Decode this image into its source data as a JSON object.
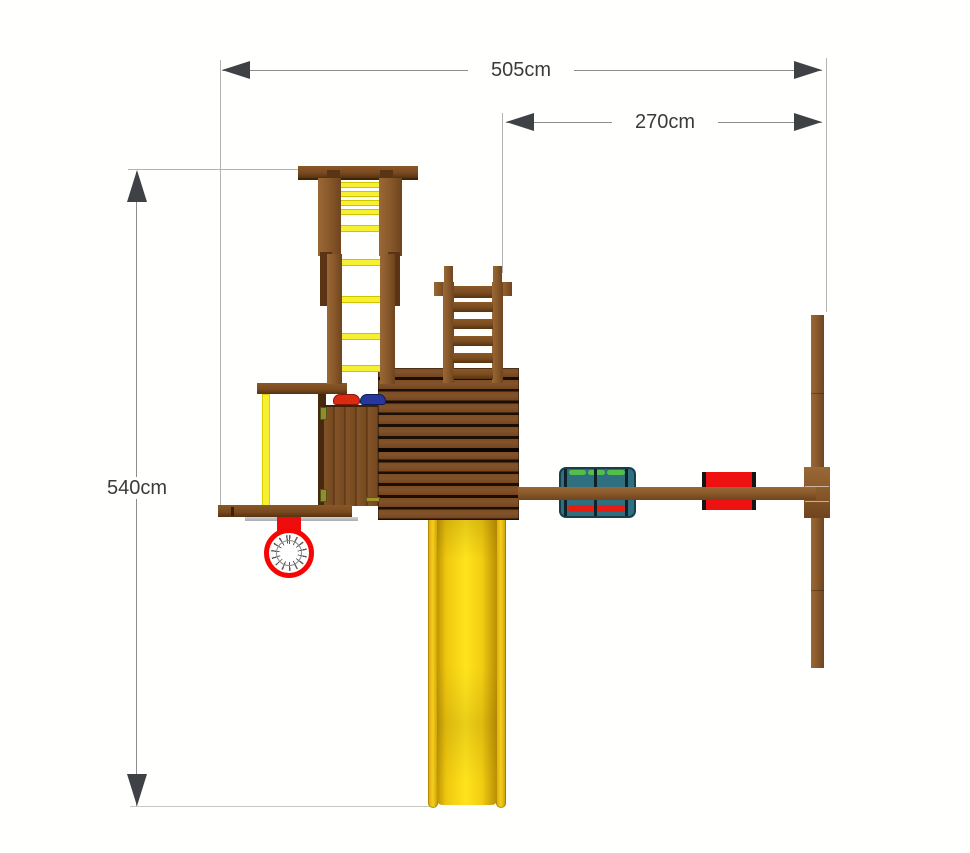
{
  "diagram": {
    "type": "playground-plan-view",
    "dimensions": {
      "total_width": "505cm",
      "swing_width": "270cm",
      "total_depth": "540cm"
    },
    "colors": {
      "wood": "#8a5a2b",
      "wood_hi": "#9a6836",
      "wood_lo": "#6f441e",
      "wood_dark": "#7a4b21",
      "yellow": "#f7f032",
      "red": "#ee1111",
      "hoop_red": "#f70505",
      "teal": "#2f6f7f",
      "green": "#55bd4a",
      "blue_hold": "#27379b",
      "dim_line": "#8c8c8c",
      "dim_ext": "#b3b3b3",
      "dim_arrow": "#3f4245",
      "dim_text": "#3b3b3b"
    }
  }
}
